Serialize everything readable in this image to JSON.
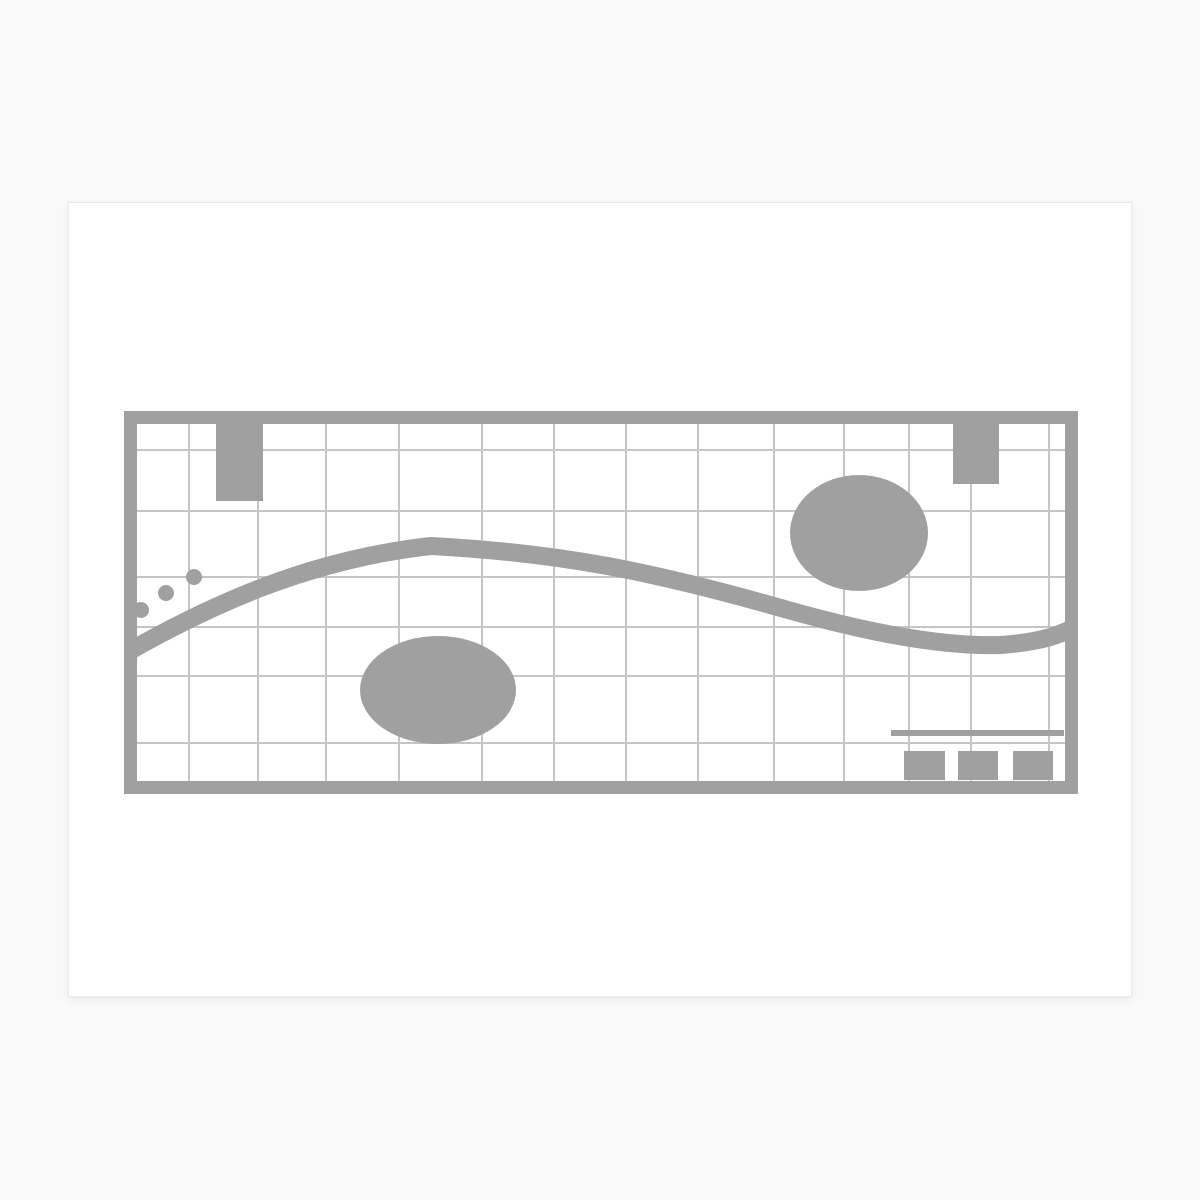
{
  "canvas": {
    "width": 1200,
    "height": 1200,
    "background": "#f9f9f9"
  },
  "card": {
    "x": 68,
    "y": 202,
    "width": 1064,
    "height": 795,
    "background": "#ffffff",
    "border_color": "#e9e9e9"
  },
  "artwork": {
    "x": 123,
    "y": 410,
    "width": 954,
    "height": 383,
    "shape_color": "#a0a0a0",
    "grid_color": "#c5c5c5",
    "grid_line_width": 2,
    "frame_thickness": 13,
    "grid_vertical_x": [
      65,
      134,
      202,
      275,
      358,
      430,
      502,
      574,
      650,
      720,
      785,
      847,
      925
    ],
    "grid_horizontal_y": [
      39,
      100,
      166,
      216,
      265,
      332
    ],
    "wave": {
      "path": "M -15 252 C 90 190, 190 148, 307 135 C 437 142, 527 160, 657 197 C 737 220, 817 236, 877 234 C 917 231, 940 224, 960 210",
      "stroke_width": 18
    },
    "ellipses": [
      {
        "cx": 314,
        "cy": 279,
        "rx": 78,
        "ry": 54
      },
      {
        "cx": 735,
        "cy": 122,
        "rx": 69,
        "ry": 58
      }
    ],
    "tabs": [
      {
        "x": 92,
        "y": 6,
        "width": 47,
        "height": 84
      },
      {
        "x": 829,
        "y": 6,
        "width": 46,
        "height": 67
      }
    ],
    "dots": [
      {
        "cx": 70,
        "cy": 166,
        "r": 8
      },
      {
        "cx": 42,
        "cy": 182,
        "r": 8
      },
      {
        "cx": 17,
        "cy": 199,
        "r": 8
      }
    ],
    "bar": {
      "x": 767,
      "y": 319,
      "width": 173,
      "height": 6
    },
    "squares": [
      {
        "x": 780,
        "y": 340,
        "width": 41,
        "height": 29
      },
      {
        "x": 834,
        "y": 340,
        "width": 40,
        "height": 29
      },
      {
        "x": 889,
        "y": 340,
        "width": 40,
        "height": 29
      }
    ]
  }
}
